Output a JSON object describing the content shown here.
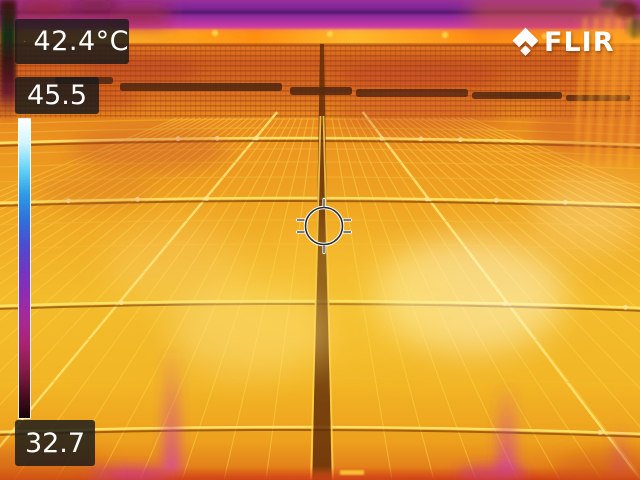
{
  "thermal_overlay": {
    "spot_temperature": "42.4°C",
    "scale_max_temperature": "45.5",
    "scale_min_temperature": "32.7",
    "brand": "FLIR"
  },
  "scale_palette": [
    "#ffffff",
    "#cdf4fe",
    "#66d3f5",
    "#2f9ce6",
    "#2f72da",
    "#4b4ecf",
    "#6d38c1",
    "#8e2cb2",
    "#a62a96",
    "#aa2372",
    "#8a1c4b",
    "#4f0f24",
    "#150406"
  ],
  "ui_colors": {
    "label_background": "rgba(26,26,26,0.84)",
    "label_text": "#ffffff",
    "reticle_color": "#ffffff"
  }
}
